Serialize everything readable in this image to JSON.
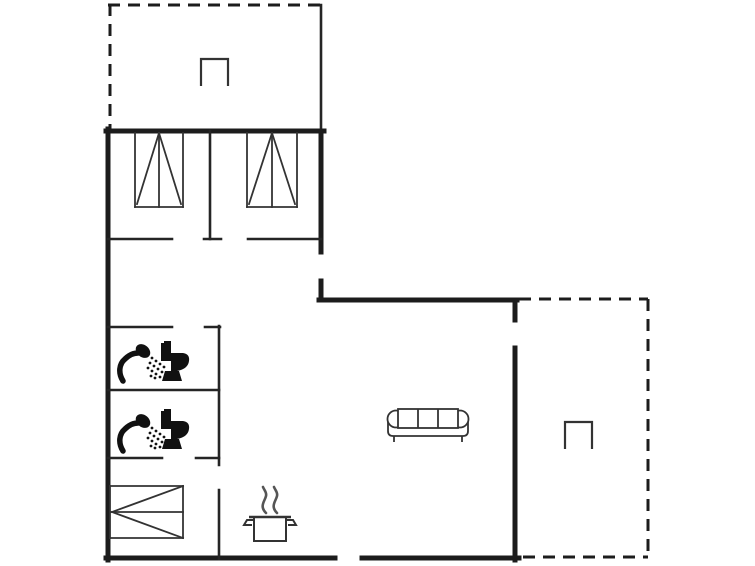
{
  "canvas": {
    "width": 755,
    "height": 566,
    "background": "#ffffff"
  },
  "style": {
    "wall_color": "#1c1c1c",
    "thin_wall_color": "#252525",
    "furniture_color": "#333333",
    "fixture_color": "#111111",
    "steam_color": "#555555",
    "wall_thick": 5,
    "wall_thin": 2.6,
    "dash_width": 3,
    "dash_pattern": "12 8",
    "furniture_stroke": 1.8
  },
  "floorplan": {
    "walls_thick": [
      [
        106,
        131,
        324,
        131
      ],
      [
        108,
        129,
        108,
        560
      ],
      [
        321,
        131,
        321,
        252
      ],
      [
        321,
        281,
        321,
        300
      ],
      [
        319,
        300,
        517,
        300
      ],
      [
        515,
        300,
        515,
        320
      ],
      [
        515,
        348,
        515,
        560
      ],
      [
        106,
        558,
        335,
        558
      ],
      [
        362,
        558,
        519,
        558
      ]
    ],
    "walls_thin": [
      [
        210,
        131,
        210,
        239
      ],
      [
        204,
        239,
        221,
        239
      ],
      [
        108,
        239,
        172,
        239
      ],
      [
        248,
        239,
        321,
        239
      ],
      [
        108,
        327,
        172,
        327
      ],
      [
        205,
        327,
        220,
        327
      ],
      [
        219,
        326,
        219,
        465
      ],
      [
        108,
        390,
        219,
        390
      ],
      [
        108,
        458,
        162,
        458
      ],
      [
        196,
        458,
        219,
        458
      ],
      [
        219,
        490,
        219,
        559
      ]
    ],
    "terrace_solid_thin": [
      [
        321,
        5,
        321,
        131
      ]
    ],
    "terrace_dashed": [
      [
        110,
        4,
        110,
        129
      ],
      [
        108,
        5,
        321,
        5
      ],
      [
        519,
        299,
        648,
        299
      ],
      [
        648,
        299,
        648,
        558
      ],
      [
        523,
        557,
        648,
        557
      ]
    ],
    "beds": [
      {
        "name": "bed-single-left",
        "orientation": "vertical",
        "x": 135,
        "y": 133,
        "w": 48,
        "h": 74
      },
      {
        "name": "bed-single-right",
        "orientation": "vertical",
        "x": 247,
        "y": 133,
        "w": 50,
        "h": 74
      },
      {
        "name": "bed-double",
        "orientation": "horizontal",
        "x": 110,
        "y": 486,
        "w": 73,
        "h": 52
      }
    ],
    "tables": [
      {
        "name": "table-top-terrace",
        "x": 201,
        "y": 59,
        "w": 27,
        "h": 27
      },
      {
        "name": "table-right-terrace",
        "x": 565,
        "y": 422,
        "w": 27,
        "h": 27
      }
    ],
    "sofa": {
      "name": "sofa",
      "x": 388,
      "y": 405
    },
    "pot": {
      "name": "cooking-pot",
      "x": 249,
      "y": 487
    },
    "bathrooms": [
      {
        "name": "bathroom-upper",
        "shower": [
          121,
          344
        ],
        "toilet": [
          157,
          341
        ]
      },
      {
        "name": "bathroom-lower",
        "shower": [
          121,
          414
        ],
        "toilet": [
          157,
          409
        ]
      }
    ],
    "shower_spray_dots": [
      [
        27,
        14
      ],
      [
        31,
        17
      ],
      [
        35,
        20
      ],
      [
        39,
        23
      ],
      [
        25,
        19
      ],
      [
        29,
        22
      ],
      [
        33,
        25
      ],
      [
        37,
        28
      ],
      [
        23,
        24
      ],
      [
        27,
        27
      ],
      [
        31,
        30
      ],
      [
        35,
        33
      ],
      [
        26,
        32
      ],
      [
        30,
        34
      ]
    ]
  }
}
